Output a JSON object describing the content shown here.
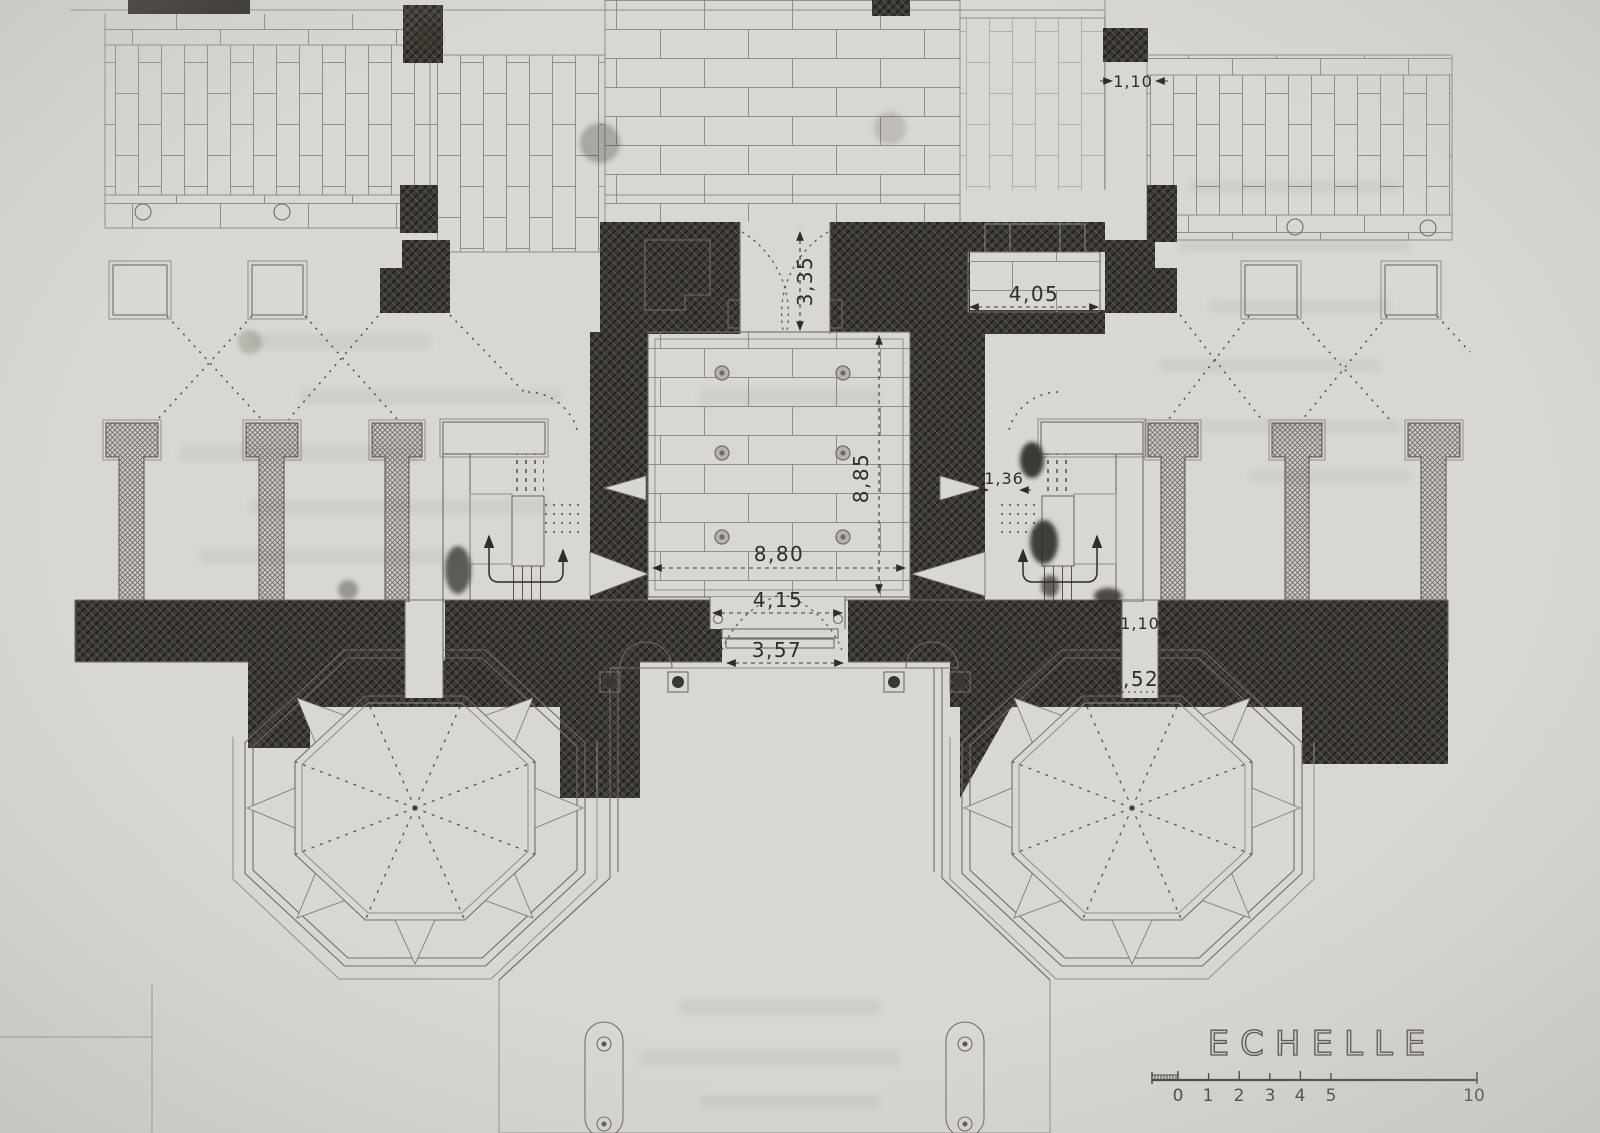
{
  "plan": {
    "dims": {
      "top_slot_width": "1,10",
      "entry_depth": "3,35",
      "side_bay_width": "4,05",
      "hall_depth": "8,85",
      "hall_width": "8,80",
      "stair_passage_width": "1,36",
      "porch_width": "4,15",
      "gate_width": "3,57",
      "court_slot_width": "1,10",
      "kiosk_entrance_width": "3,52"
    },
    "scale": {
      "title": "ECHELLE",
      "ticks": [
        "0",
        "1",
        "2",
        "3",
        "4",
        "5"
      ],
      "end_tick": "10"
    }
  }
}
